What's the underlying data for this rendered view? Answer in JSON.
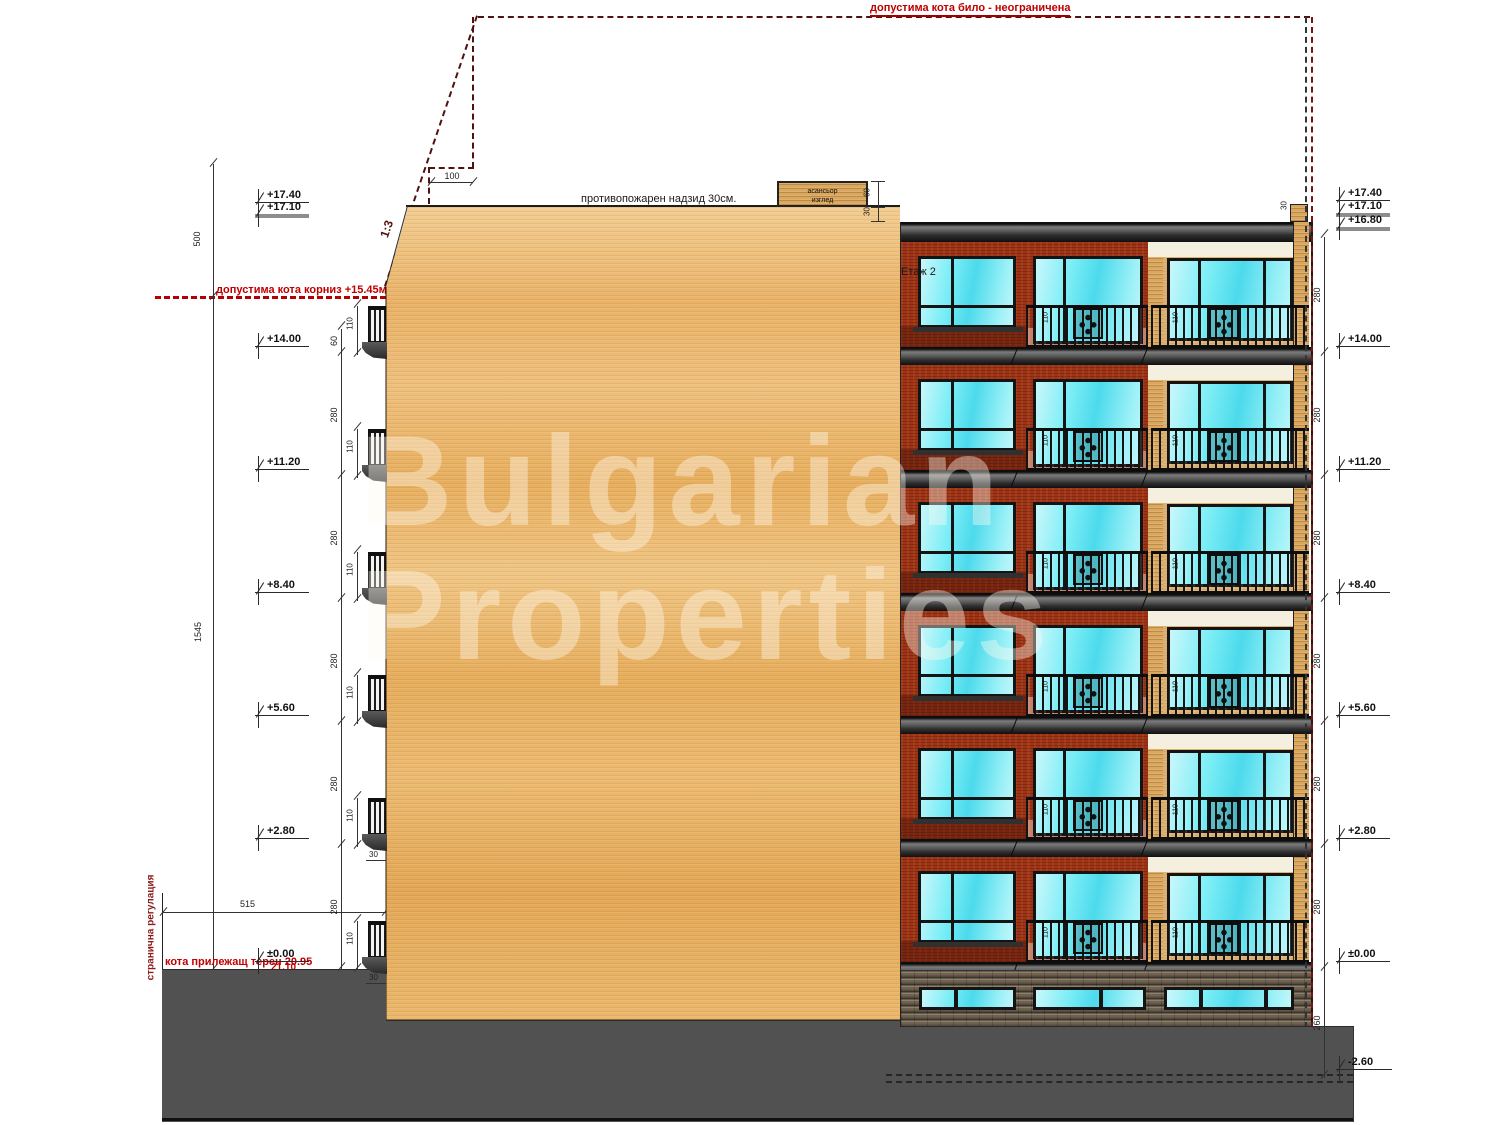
{
  "drawing": {
    "ridge_limit": "допустима кота било - неограничена",
    "cornice_limit": "допустима кота корниз +15.45м.",
    "fire_parapet": "противопожарен надзид 30см.",
    "slope_ratio": "1:3",
    "side_regulation": "странична регулация",
    "terrain_level": "кота прилежащ терен 20.95",
    "ground_alt": "21.10",
    "floor_tag": "Етаж 2",
    "elevator": [
      "асансьор",
      "изглед"
    ]
  },
  "levels": {
    "left_top": [
      "+17.40",
      "+17.10"
    ],
    "left": [
      "+14.00",
      "+11.20",
      "+8.40",
      "+5.60",
      "+2.80",
      "±0.00"
    ],
    "right": [
      "+17.40",
      "+17.10",
      "+16.80",
      "+14.00",
      "+11.20",
      "+8.40",
      "+5.60",
      "+2.80",
      "±0.00",
      "-2.60"
    ]
  },
  "dims": {
    "upper_total": "500",
    "building_total": "1545",
    "floor": "280",
    "basement": "260",
    "balcony_height": "110",
    "roof_step": "60",
    "setback": "100",
    "side_offset": "515",
    "balcony_depth": "30",
    "parapet_small": "30",
    "elevator_height": "60",
    "fire_step": "30"
  },
  "watermark": [
    "Bulgarian",
    "Properties"
  ],
  "colors": {
    "regulation_red": "#b30000",
    "dashed_maroon": "#4f1210",
    "brick": "#9e3415",
    "wood": "#e9b267",
    "beige": "#ddb273",
    "glass": "#4cdaec",
    "slab": "#2f2f2f",
    "stone": "#6e6150",
    "ground": "#515151"
  }
}
